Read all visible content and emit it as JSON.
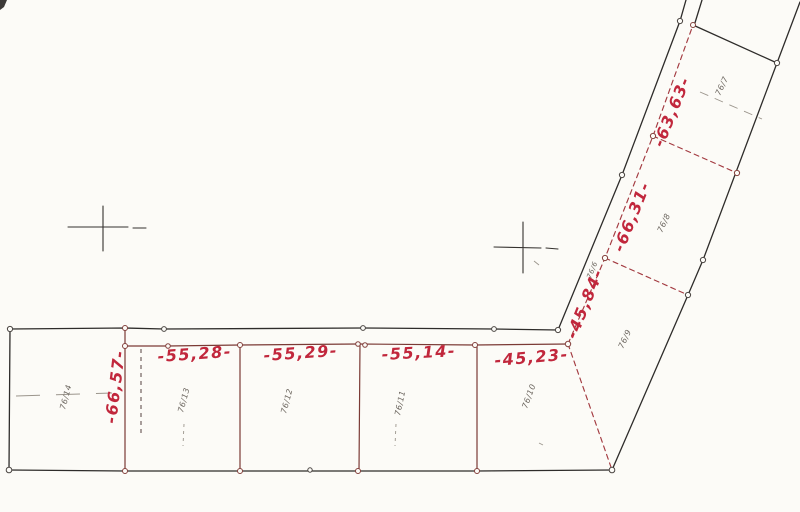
{
  "sketch": {
    "measurements": {
      "depth_left": "-66,57-",
      "frontage_76_13": "-55,28-",
      "frontage_76_12": "-55,29-",
      "frontage_76_11": "-55,14-",
      "frontage_76_10": "-45,23-",
      "road_frontage_76_9": "-45,84-",
      "road_frontage_76_8": "-66,31-",
      "road_frontage_76_7": "-63,63-"
    },
    "parcel_labels": {
      "p76_14": "76/14",
      "p76_13": "76/13",
      "p76_12": "76/12",
      "p76_11": "76/11",
      "p76_10": "76/10",
      "p76_9": "76/9",
      "p76_8": "76/8",
      "p76_7": "76/7",
      "p76_6": "76/6"
    },
    "colors": {
      "paper": "#fcfbf7",
      "ink_black": "#2e2c2a",
      "boundary_maroon": "#7b3a35",
      "boundary_red_dashed": "#a33a40",
      "handwriting_red": "#c1273c",
      "parcel_label_gray": "#6a645d"
    }
  }
}
